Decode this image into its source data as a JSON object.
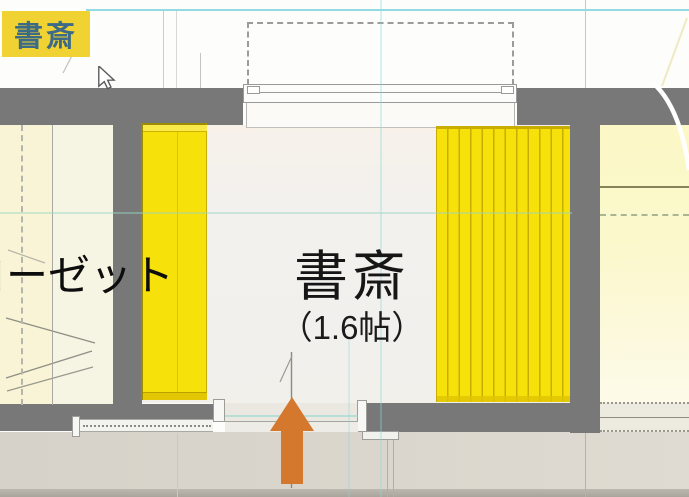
{
  "badge": {
    "label": "書斎"
  },
  "plan": {
    "study": {
      "name": "書斎",
      "area": "（1.6帖）"
    },
    "closet_label": "ローゼット",
    "entry_arrow_direction": "up",
    "colors": {
      "badge_bg": "#f0d232",
      "badge_text": "#3d6b85",
      "wall_gray": "#787878",
      "furniture_yellow": "#f6e10a",
      "furniture_yellow_edge": "#c9ad00",
      "arrow_orange": "#d4782e",
      "guide_cyan": "#8fd9e2",
      "left_room_floor": "#f8f4d5",
      "right_room_floor": "#fbf7c6",
      "study_floor": "#f2f1ec",
      "hallway": "#d9d5cc"
    }
  }
}
